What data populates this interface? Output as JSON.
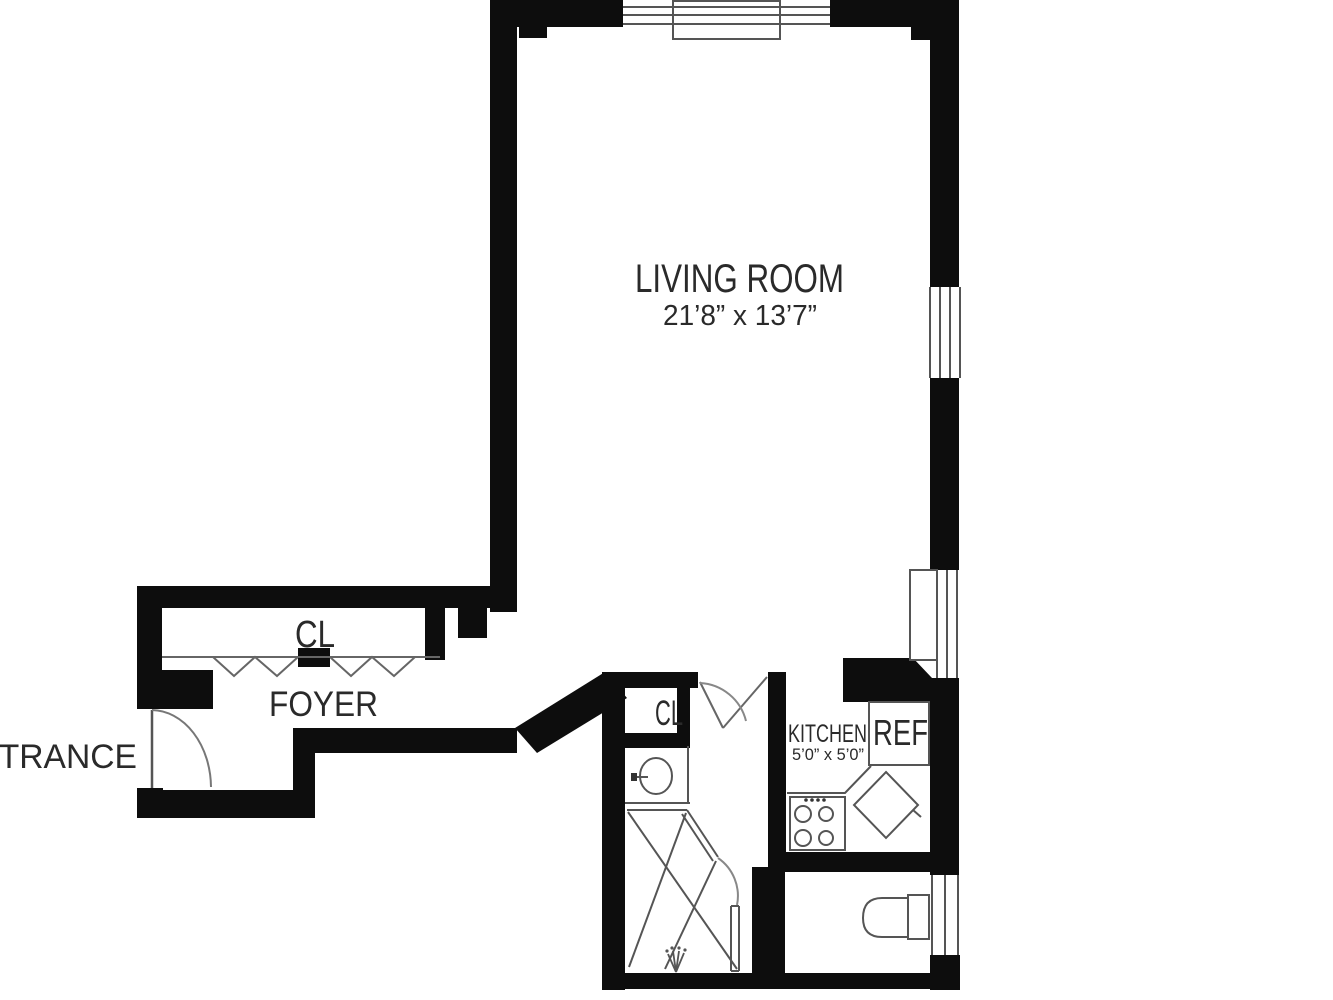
{
  "colors": {
    "wall": "#0d0d0d",
    "thin_line": "#555555",
    "door_arc": "#777777",
    "text": "#2a2a2a",
    "background": "#ffffff"
  },
  "labels": {
    "living_room": "LIVING ROOM",
    "living_room_dims": "21’8” x 13’7”",
    "foyer": "FOYER",
    "foyer_closet": "CL",
    "entrance": "ENTRANCE",
    "bath_closet": "CL",
    "kitchen": "KITCHEN",
    "kitchen_dims": "5’0” x 5’0”",
    "refrigerator": "REF"
  }
}
